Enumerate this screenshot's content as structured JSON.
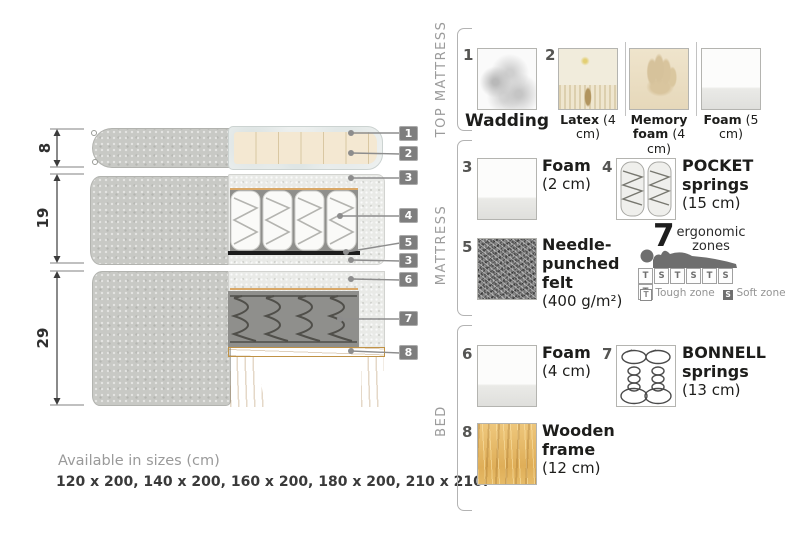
{
  "diagram": {
    "dimension_labels": [
      "8",
      "19",
      "29"
    ],
    "callout_numbers": [
      "1",
      "2",
      "3",
      "4",
      "5",
      "3",
      "6",
      "7",
      "8"
    ]
  },
  "legend": {
    "groups": [
      {
        "label": "TOP MATTRESS",
        "items": [
          {
            "num": "1",
            "name": "Wadding",
            "size": "",
            "icon": "wadding-texture"
          },
          {
            "num": "2",
            "name": "Latex",
            "size": "(4 cm)",
            "icon": "latex-texture"
          },
          {
            "num": "",
            "name": "Memory foam",
            "size": "(4 cm)",
            "icon": "memory-foam-texture"
          },
          {
            "num": "",
            "name": "Foam",
            "size": "(5 cm)",
            "icon": "foam-texture"
          }
        ]
      },
      {
        "label": "MATTRESS",
        "items": [
          {
            "num": "3",
            "name": "Foam",
            "size": "(2 cm)",
            "icon": "foam-texture"
          },
          {
            "num": "4",
            "name": "POCKET springs",
            "size": "(15 cm)",
            "icon": "pocket-springs-drawing"
          },
          {
            "num": "5",
            "name": "Needle-punched felt",
            "size": "(400 g/m²)",
            "icon": "felt-texture"
          }
        ],
        "ergonomic": {
          "count": "7",
          "caption_line1": "ergonomic",
          "caption_line2": "zones",
          "zones": [
            "T",
            "S",
            "T",
            "S",
            "T",
            "S",
            "T"
          ],
          "tough_symbol": "T",
          "tough_label": "Tough zone",
          "soft_symbol": "S",
          "soft_label": "Soft zone"
        }
      },
      {
        "label": "BED",
        "items": [
          {
            "num": "6",
            "name": "Foam",
            "size": "(4 cm)",
            "icon": "foam-texture"
          },
          {
            "num": "7",
            "name": "BONNELL springs",
            "size": "(13 cm)",
            "icon": "bonnell-springs-drawing"
          },
          {
            "num": "8",
            "name": "Wooden frame",
            "size": "(12 cm)",
            "icon": "wood-texture"
          }
        ]
      }
    ]
  },
  "footer": {
    "title": "Available in sizes (cm)",
    "sizes": "120 x 200, 140 x 200, 160 x 200, 180 x 200, 210 x 210."
  },
  "colors": {
    "fabric_gray": "#c8c9c5",
    "foam_speckle": "#e9eae7",
    "latex_cream": "#f4e8d2",
    "wood_tan": "#e0b161",
    "felt_dark": "#757575",
    "badge_gray": "#7e7e7e",
    "accent_tan": "#d9a868",
    "bonnell_gray": "#8f8f8c"
  }
}
